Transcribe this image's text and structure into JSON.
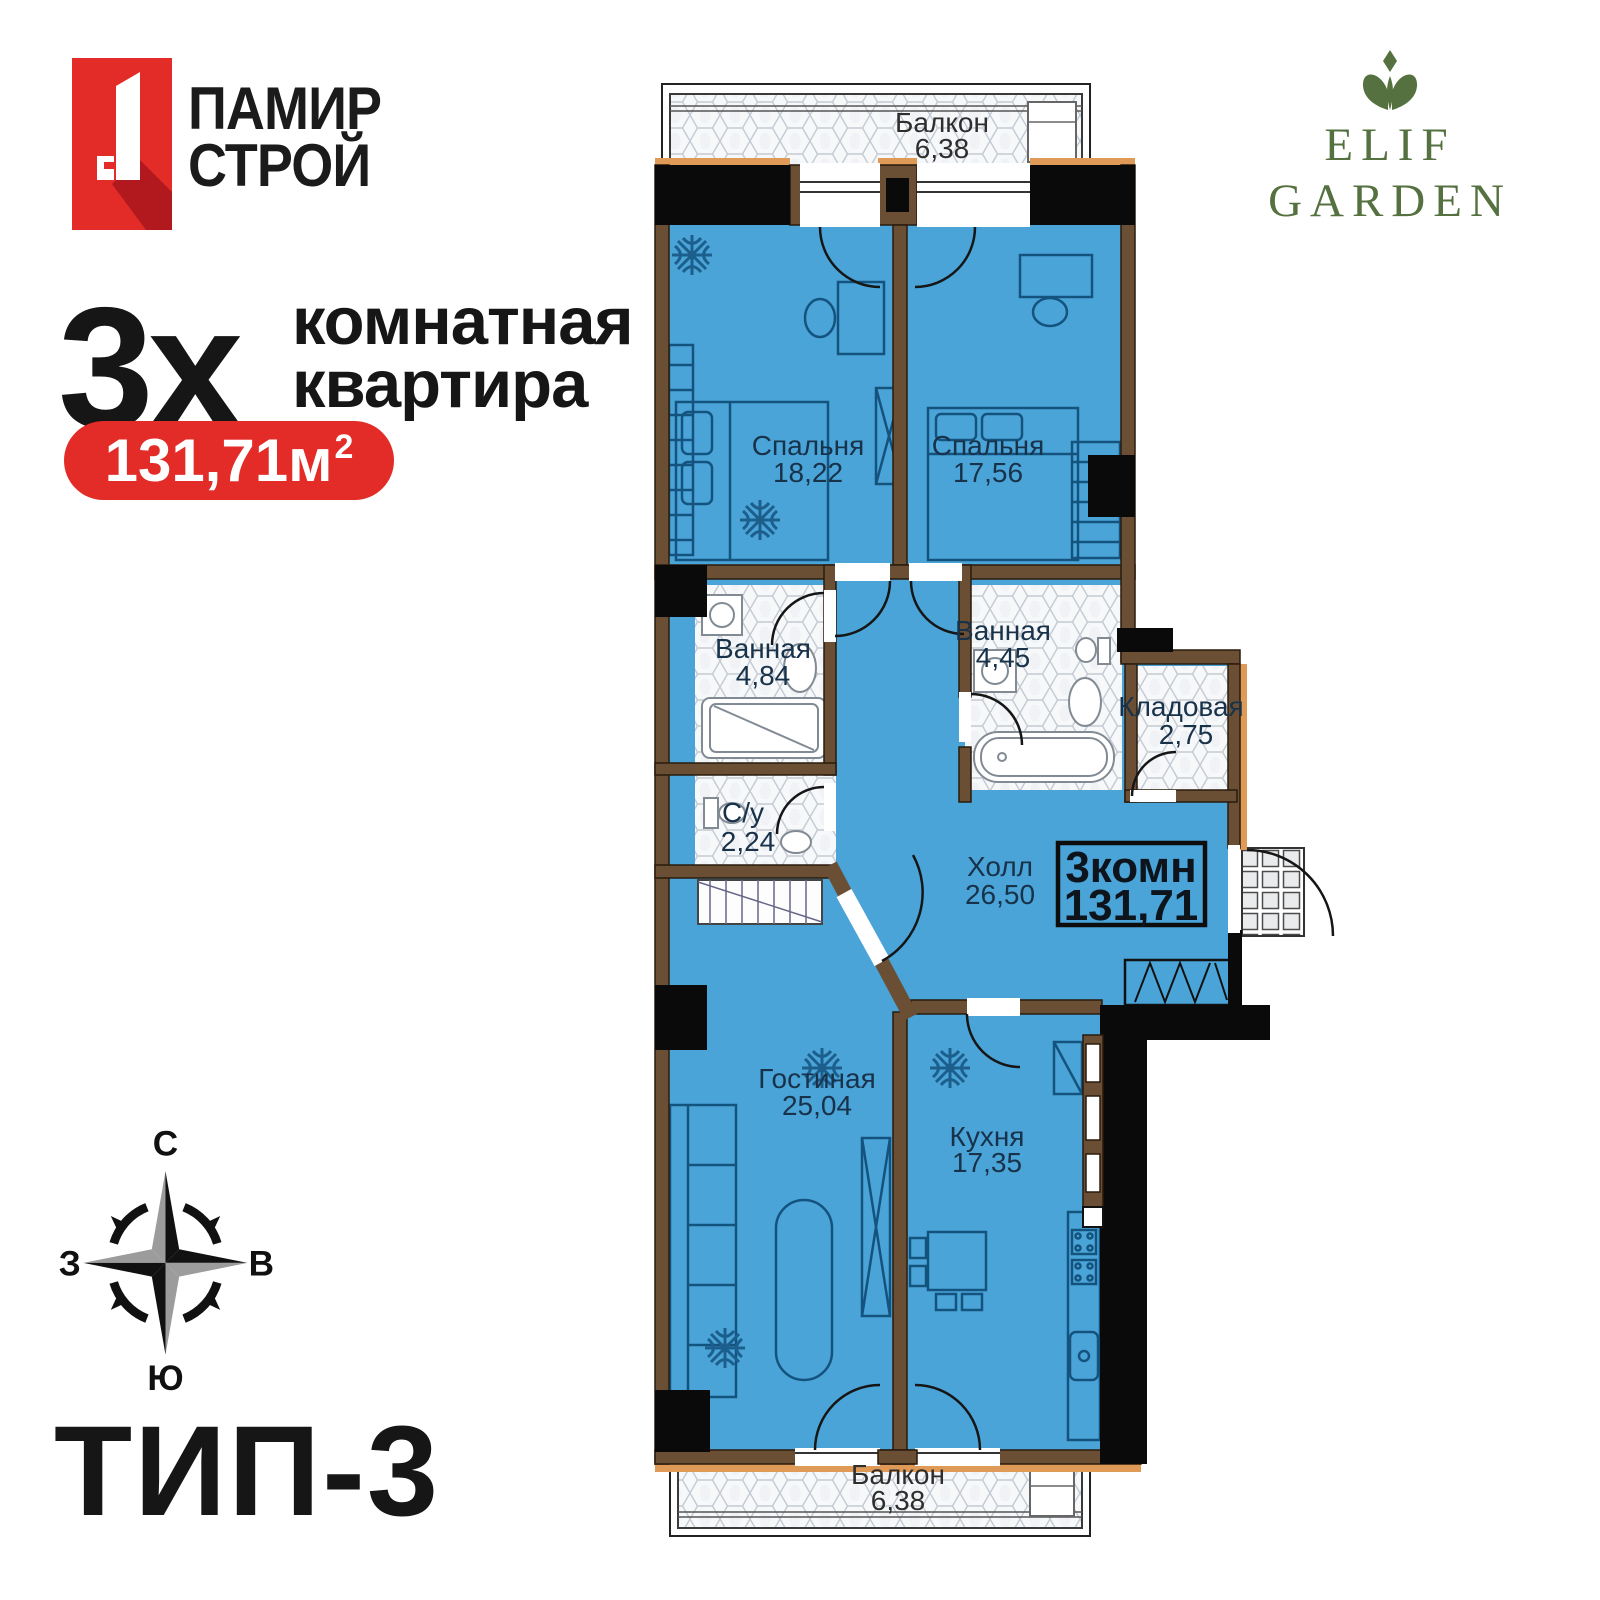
{
  "branding": {
    "developer": {
      "name_line1": "ПАМИР",
      "name_line2": "СТРОЙ"
    },
    "project": {
      "name_line1": "ELIF",
      "name_line2": "GARDEN"
    }
  },
  "headline": {
    "count": "3х",
    "line1": "комнатная",
    "line2": "квартира"
  },
  "area_badge": {
    "value": "131,71м",
    "sup": "2"
  },
  "type_label": "ТИП-3",
  "compass": {
    "north": "С",
    "east": "В",
    "south": "Ю",
    "west": "З"
  },
  "plan": {
    "summary": {
      "rooms": "3комн",
      "area": "131,71"
    },
    "rooms": [
      {
        "name": "Балкон",
        "area": "6,38"
      },
      {
        "name": "Спальня",
        "area": "18,22"
      },
      {
        "name": "Спальня",
        "area": "17,56"
      },
      {
        "name": "Ванная",
        "area": "4,84"
      },
      {
        "name": "Ванная",
        "area": "4,45"
      },
      {
        "name": "Кладовая",
        "area": "2,75"
      },
      {
        "name": "С/у",
        "area": "2,24"
      },
      {
        "name": "Холл",
        "area": "26,50"
      },
      {
        "name": "Гостиная",
        "area": "25,04"
      },
      {
        "name": "Кухня",
        "area": "17,35"
      },
      {
        "name": "Балкон",
        "area": "6,38"
      }
    ],
    "colors": {
      "accent_red": "#e32b27",
      "brand_green": "#55713f",
      "room_fill": "#4aa4d8",
      "wall_brown": "#6b4f35",
      "wall_black": "#0a0a0a",
      "wall_orange": "#e09a57",
      "label_navy": "#18324a"
    }
  }
}
